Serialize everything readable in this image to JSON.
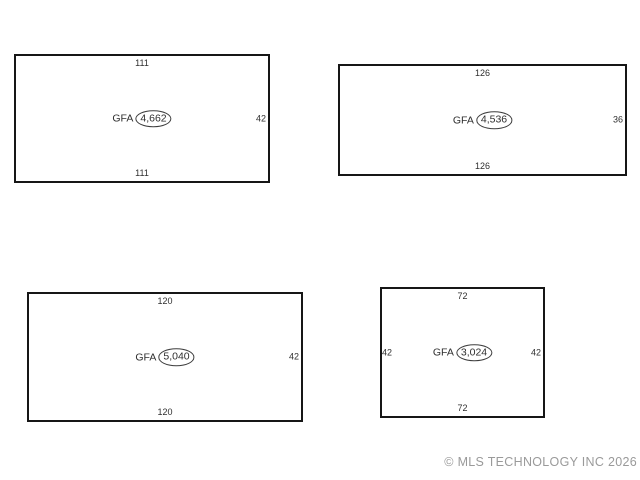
{
  "colors": {
    "background": "#ffffff",
    "outline": "#161616",
    "text": "#2e2e2e",
    "footer_text": "#9a9a9a"
  },
  "units": [
    {
      "name": "unit-1",
      "gfa_label": "GFA",
      "gfa_value": "4,662",
      "dim_top": "111",
      "dim_bottom": "111",
      "dim_right": "42"
    },
    {
      "name": "unit-2",
      "gfa_label": "GFA",
      "gfa_value": "4,536",
      "dim_top": "126",
      "dim_bottom": "126",
      "dim_right": "36"
    },
    {
      "name": "unit-3",
      "gfa_label": "GFA",
      "gfa_value": "5,040",
      "dim_top": "120",
      "dim_bottom": "120",
      "dim_right": "42"
    },
    {
      "name": "unit-4",
      "gfa_label": "GFA",
      "gfa_value": "3,024",
      "dim_top": "72",
      "dim_bottom": "72",
      "dim_left": "42",
      "dim_right": "42"
    }
  ],
  "footer": {
    "copyright": "© MLS TECHNOLOGY INC 2026"
  }
}
